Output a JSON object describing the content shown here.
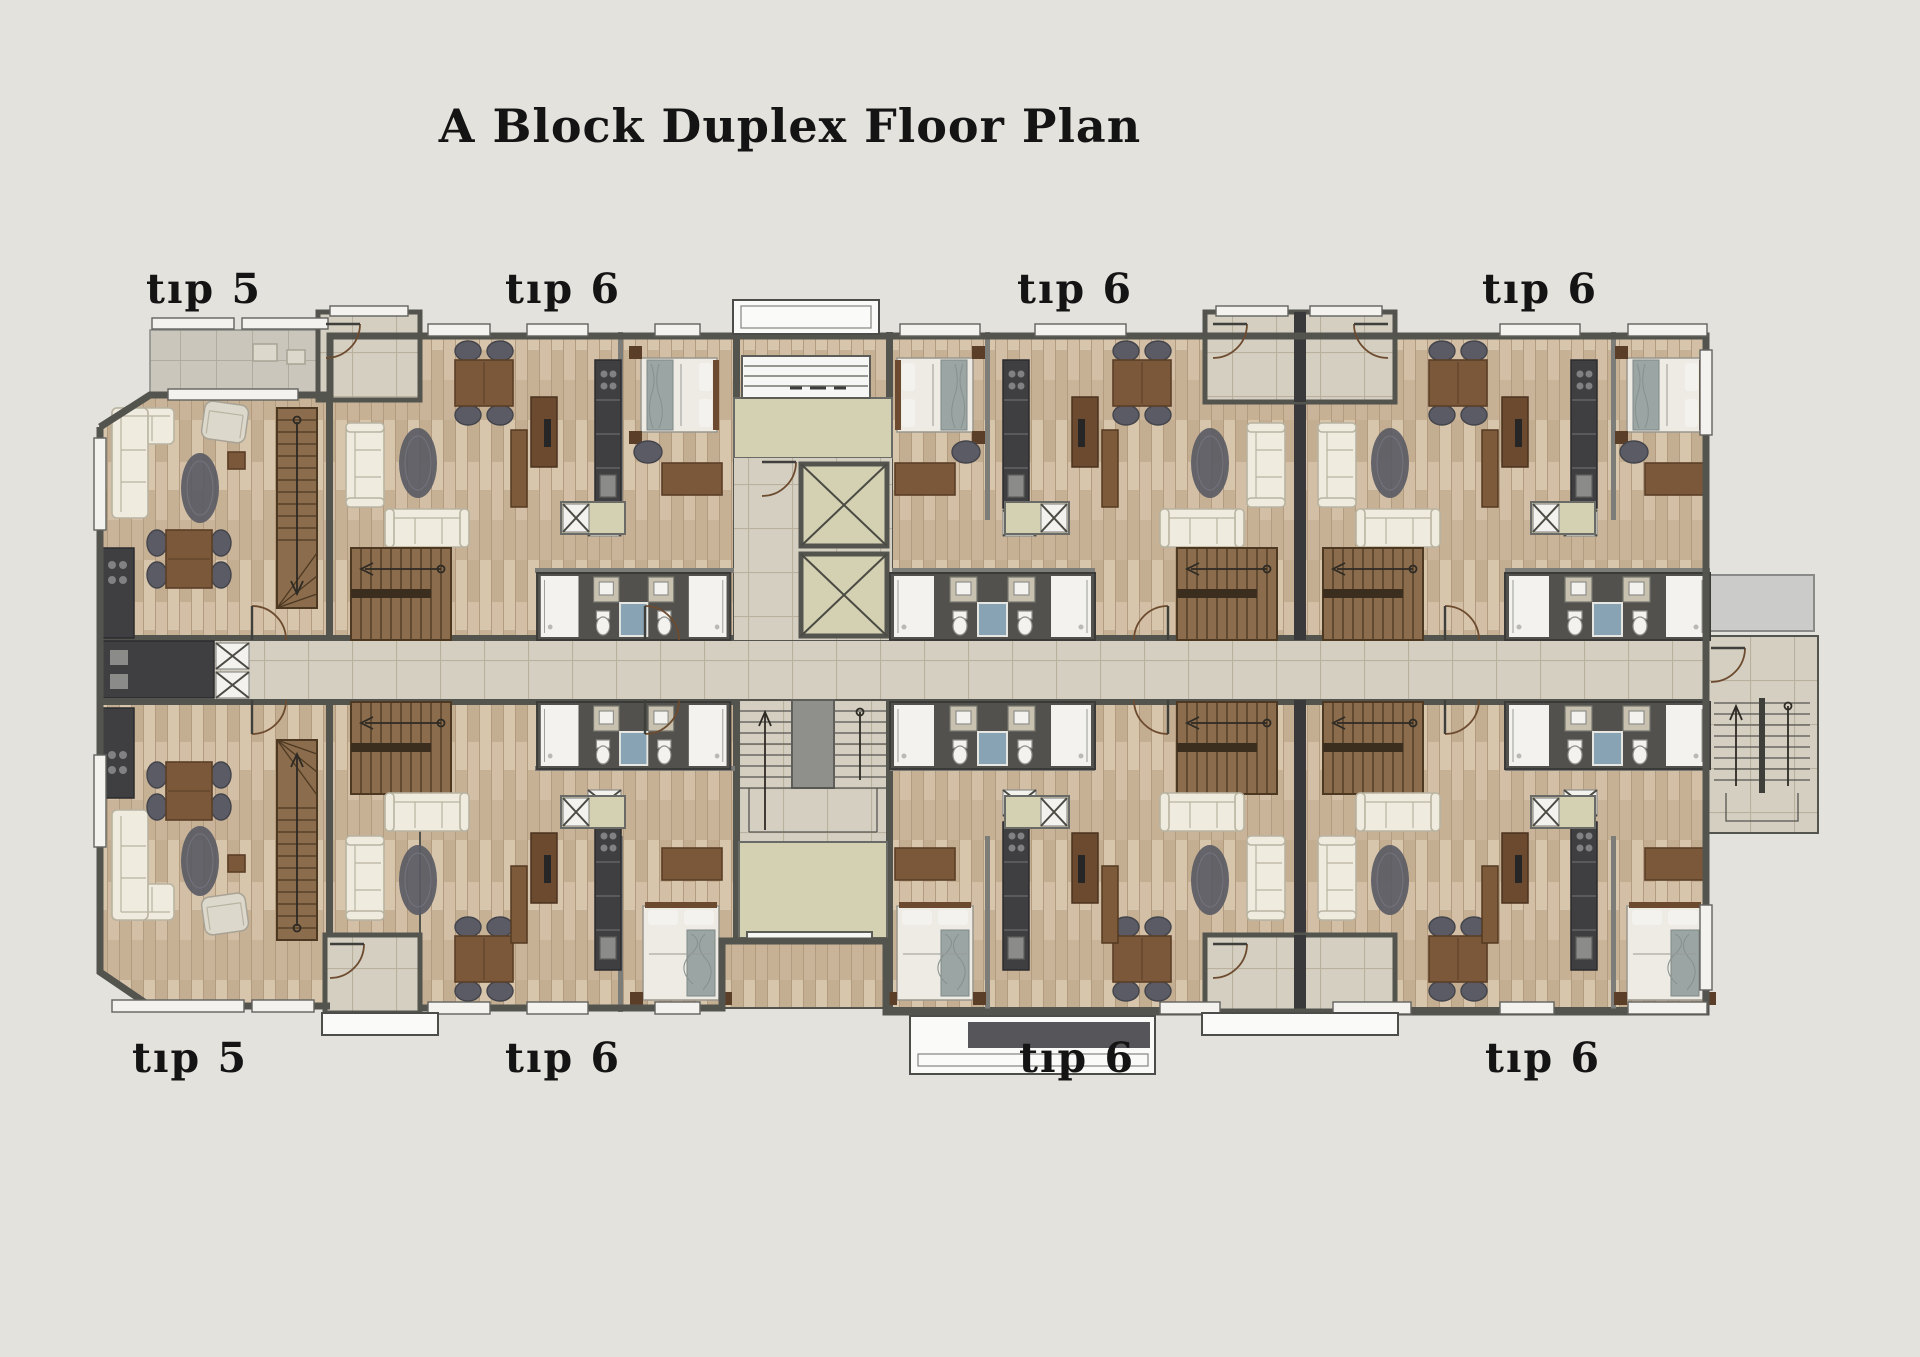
{
  "title": "A Block Duplex Floor Plan",
  "units": {
    "top": [
      {
        "label": "tıp 5"
      },
      {
        "label": "tıp 6"
      },
      {
        "label": "tıp 6"
      },
      {
        "label": "tıp 6"
      }
    ],
    "bottom": [
      {
        "label": "tıp 5"
      },
      {
        "label": "tıp 6"
      },
      {
        "label": "tıp 6"
      },
      {
        "label": "tıp 6"
      }
    ]
  },
  "colors": {
    "bg": "#e4e2dd",
    "text": "#141414",
    "wall": "#54544f",
    "wallDark": "#39393b",
    "wallLight": "#7c7c78",
    "wood": "#ccb89e",
    "woodLight": "#d7c5ac",
    "woodMid": "#c3ae92",
    "woodLine": "#b29b7f",
    "tile": "#d5cfc2",
    "tileLine": "#b9b09e",
    "balconyTile": "#cbc6bb",
    "olive": "#d4d1b3",
    "bathFloor": "#52514d",
    "fixture": "#f3f2ee",
    "vanity": "#c8c1af",
    "showerBlue": "#87a3b4",
    "brown": "#7a5839",
    "brownDark": "#5b3e27",
    "seatDark": "#5a5b64",
    "sofa": "#efebdf",
    "sofaTrim": "#b9b3a1",
    "stairWood": "#8b6c4c",
    "stairLine": "#4d3922",
    "concrete": "#8f8f8c",
    "canopy": "#fafaf8",
    "entrySteps": "#f6f6f4",
    "throw": "#9ba6a4",
    "bedsheet": "#edebe4",
    "doorArc": "#6d4b2f"
  }
}
